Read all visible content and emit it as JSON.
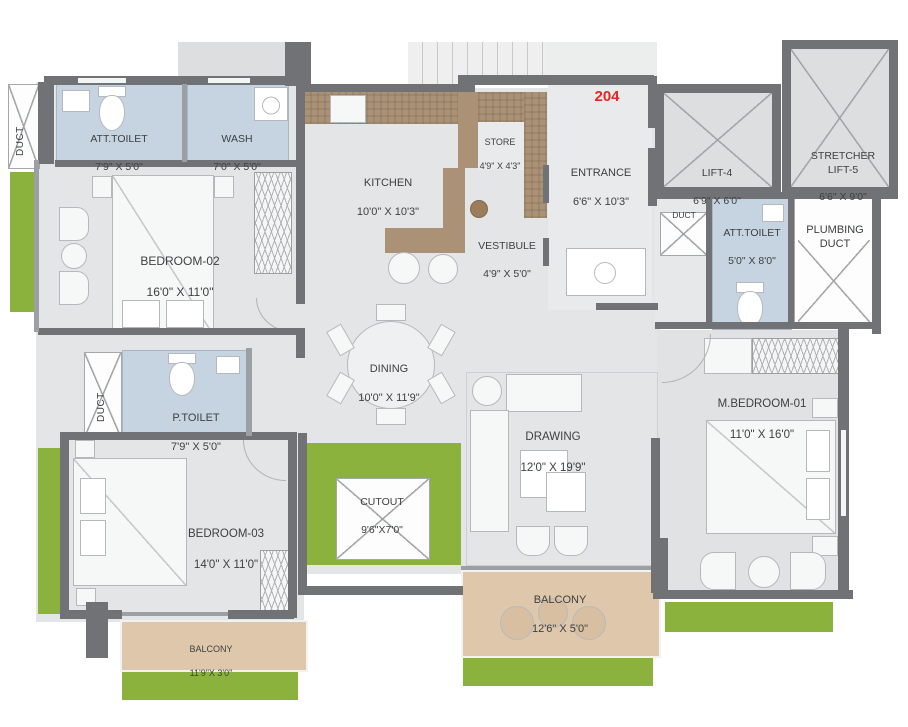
{
  "unit_number": "204",
  "rooms": {
    "duct_top_left": {
      "name": "DUCT"
    },
    "att_toilet_1": {
      "name": "ATT.TOILET",
      "dims": "7'9\" X 5'0\""
    },
    "wash": {
      "name": "WASH",
      "dims": "7'0\" X 5'0\""
    },
    "kitchen": {
      "name": "KITCHEN",
      "dims": "10'0\" X 10'3\""
    },
    "store": {
      "name": "STORE",
      "dims": "4'9\" X 4'3\""
    },
    "vestibule": {
      "name": "VESTIBULE",
      "dims": "4'9\" X 5'0\""
    },
    "entrance": {
      "name": "ENTRANCE",
      "dims": "6'6\" X 10'3\""
    },
    "lift_4": {
      "name": "LIFT-4",
      "dims": "6'9\" X 6'0\""
    },
    "stretcher_lift_5": {
      "name": "STRETCHER\nLIFT-5",
      "dims": "6'6\" X 9'0\""
    },
    "duct_lobby": {
      "name": "DUCT"
    },
    "att_toilet_2": {
      "name": "ATT.TOILET",
      "dims": "5'0\" X 8'0\""
    },
    "plumbing_duct": {
      "name": "PLUMBING\nDUCT"
    },
    "bedroom_02": {
      "name": "BEDROOM-02",
      "dims": "16'0\" X 11'0\""
    },
    "dining": {
      "name": "DINING",
      "dims": "10'0\" X 11'9\""
    },
    "drawing": {
      "name": "DRAWING",
      "dims": "12'0\" X 19'9\""
    },
    "p_toilet": {
      "name": "P.TOILET",
      "dims": "7'9\" X 5'0\""
    },
    "duct_left": {
      "name": "DUCT"
    },
    "m_bedroom_01": {
      "name": "M.BEDROOM-01",
      "dims": "11'0\" X 16'0\""
    },
    "bedroom_03": {
      "name": "BEDROOM-03",
      "dims": "14'0\" X 11'0\""
    },
    "cutout": {
      "name": "CUTOUT",
      "dims": "9'6\"X7'0\""
    },
    "balcony_main": {
      "name": "BALCONY",
      "dims": "12'6\" X 5'0\""
    },
    "balcony_small": {
      "name": "BALCONY",
      "dims": "11'9\"X 3'0\""
    }
  },
  "colors": {
    "wall": "#707275",
    "floor": "#e3e5e6",
    "toilet_blue": "#c6d4e2",
    "counter_brown": "#ab9176",
    "balcony_tan": "#dfc7ab",
    "lawn_green": "#8cb23e",
    "unit_red": "#e02a23"
  }
}
